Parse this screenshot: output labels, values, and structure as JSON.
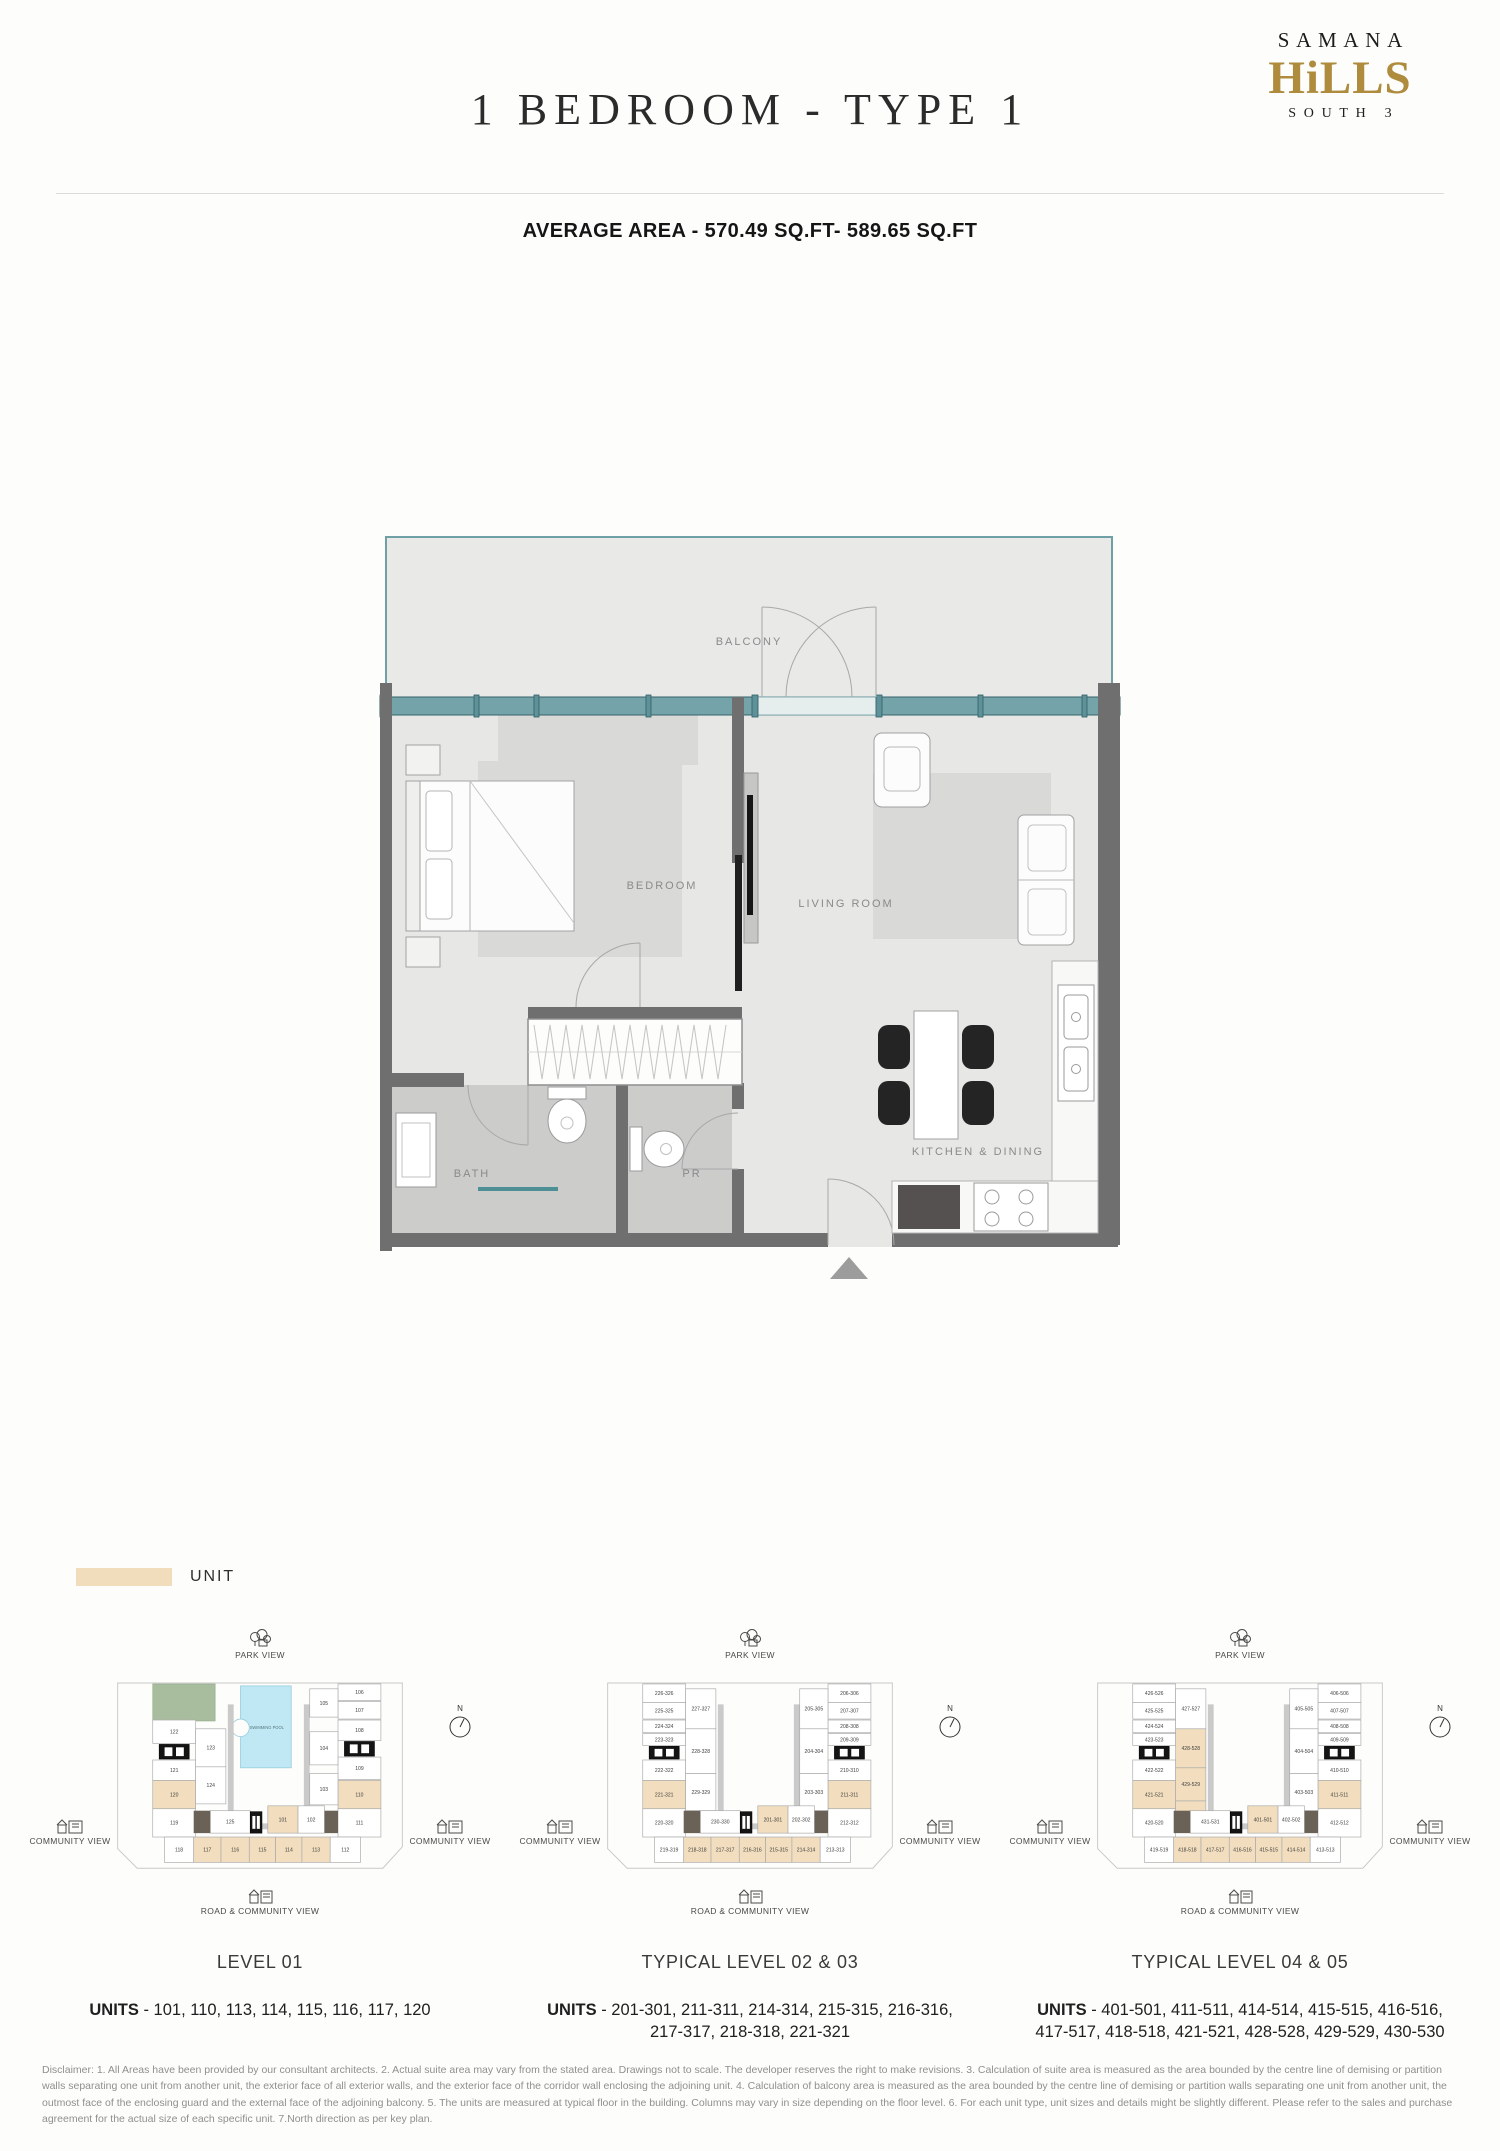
{
  "page": {
    "title": "1 BEDROOM - TYPE 1",
    "average_area": "AVERAGE AREA - 570.49 SQ.FT- 589.65 SQ.FT"
  },
  "logo": {
    "line1": "SAMANA",
    "line2": "HiLLS",
    "line3": "SOUTH 3",
    "gold": "#AF8C3D"
  },
  "legend": {
    "label": "UNIT",
    "swatch_color": "#F1DCBB"
  },
  "floorplan": {
    "labels": {
      "balcony": "BALCONY",
      "bedroom": "BEDROOM",
      "living": "LIVING ROOM",
      "bath": "BATH",
      "pr": "PR",
      "kitchen": "KITCHEN & DINING"
    },
    "colors": {
      "wall": "#6F6F6F",
      "glass": "#74A4AA",
      "highlight": "#F1DCBB"
    }
  },
  "keyplans": [
    {
      "caption": "LEVEL 01",
      "geometry": "level1",
      "compass": "N",
      "pool_label": "SWIMMING POOL",
      "views": {
        "park": "PARK VIEW",
        "community_left": "COMMUNITY VIEW",
        "community_right": "COMMUNITY VIEW",
        "road": "ROAD & COMMUNITY VIEW"
      },
      "units_prefix": "UNITS",
      "units_rest": " - 101, 110, 113, 114, 115, 116, 117, 120",
      "cells": {
        "left_outer": [
          {
            "t": "122"
          },
          {
            "t": "121"
          },
          {
            "t": "120",
            "h": 1
          },
          {
            "t": "119"
          }
        ],
        "left_inner": [
          {
            "t": "123"
          },
          {
            "t": "124"
          }
        ],
        "inner_bottom": {
          "t": "125"
        },
        "bottom_mid": [
          {
            "t": "101",
            "h": 1
          },
          {
            "t": "102"
          }
        ],
        "right_inner": [
          {
            "t": "105"
          },
          {
            "t": "104"
          },
          {
            "t": "103"
          }
        ],
        "right_outer": [
          {
            "t": "106"
          },
          {
            "t": "107"
          },
          {
            "t": "108"
          },
          {
            "t": "109"
          },
          {
            "t": "110",
            "h": 1
          },
          {
            "t": "111"
          }
        ],
        "bottom_row": [
          {
            "t": "118"
          },
          {
            "t": "117",
            "h": 1
          },
          {
            "t": "116",
            "h": 1
          },
          {
            "t": "115",
            "h": 1
          },
          {
            "t": "114",
            "h": 1
          },
          {
            "t": "113",
            "h": 1
          },
          {
            "t": "112"
          }
        ]
      }
    },
    {
      "caption": "TYPICAL LEVEL 02 & 03",
      "geometry": "typical",
      "compass": "N",
      "views": {
        "park": "PARK VIEW",
        "community_left": "COMMUNITY VIEW",
        "community_right": "COMMUNITY VIEW",
        "road": "ROAD & COMMUNITY VIEW"
      },
      "units_prefix": "UNITS",
      "units_rest": " - 201-301, 211-311, 214-314, 215-315, 216-316, 217-317, 218-318, 221-321",
      "cells": {
        "left_outer": [
          {
            "t": "226-326"
          },
          {
            "t": "225-325"
          },
          {
            "t": "224-324"
          },
          {
            "t": "223-323"
          },
          {
            "t": "222-322"
          },
          {
            "t": "221-321",
            "h": 1
          },
          {
            "t": "220-320"
          }
        ],
        "left_inner": [
          {
            "t": "227-327"
          },
          {
            "t": "228-328"
          },
          {
            "t": "229-329"
          }
        ],
        "inner_bottom": {
          "t": "230-330"
        },
        "bottom_mid": [
          {
            "t": "201-301",
            "h": 1
          },
          {
            "t": "202-302"
          }
        ],
        "right_inner": [
          {
            "t": "205-305"
          },
          {
            "t": "204-304"
          },
          {
            "t": "203-303"
          }
        ],
        "right_outer": [
          {
            "t": "206-306"
          },
          {
            "t": "207-307"
          },
          {
            "t": "208-308"
          },
          {
            "t": "209-309"
          },
          {
            "t": "210-310"
          },
          {
            "t": "211-311",
            "h": 1
          },
          {
            "t": "212-312"
          }
        ],
        "bottom_row": [
          {
            "t": "219-319"
          },
          {
            "t": "218-318",
            "h": 1
          },
          {
            "t": "217-317",
            "h": 1
          },
          {
            "t": "216-316",
            "h": 1
          },
          {
            "t": "215-315",
            "h": 1
          },
          {
            "t": "214-314",
            "h": 1
          },
          {
            "t": "213-313"
          }
        ]
      }
    },
    {
      "caption": "TYPICAL LEVEL 04 & 05",
      "geometry": "typical",
      "left_inner_geo": "g4",
      "compass": "N",
      "views": {
        "park": "PARK VIEW",
        "community_left": "COMMUNITY VIEW",
        "community_right": "COMMUNITY VIEW",
        "road": "ROAD & COMMUNITY VIEW"
      },
      "units_prefix": "UNITS",
      "units_rest": " - 401-501, 411-511, 414-514, 415-515, 416-516, 417-517, 418-518, 421-521, 428-528, 429-529, 430-530",
      "cells": {
        "left_outer": [
          {
            "t": "426-526"
          },
          {
            "t": "425-525"
          },
          {
            "t": "424-524"
          },
          {
            "t": "423-523"
          },
          {
            "t": "422-522"
          },
          {
            "t": "421-521",
            "h": 1
          },
          {
            "t": "420-520"
          }
        ],
        "left_inner": [
          {
            "t": "427-527"
          },
          {
            "t": "428-528",
            "h": 1
          },
          {
            "t": "429-529",
            "h": 1
          },
          {
            "t": "430-530",
            "h": 1
          }
        ],
        "inner_bottom": {
          "t": "431-531"
        },
        "bottom_mid": [
          {
            "t": "401-501",
            "h": 1
          },
          {
            "t": "402-502"
          }
        ],
        "right_inner": [
          {
            "t": "405-505"
          },
          {
            "t": "404-504"
          },
          {
            "t": "403-503"
          }
        ],
        "right_outer": [
          {
            "t": "406-506"
          },
          {
            "t": "407-507"
          },
          {
            "t": "408-508"
          },
          {
            "t": "409-509"
          },
          {
            "t": "410-510"
          },
          {
            "t": "411-511",
            "h": 1
          },
          {
            "t": "412-512"
          }
        ],
        "bottom_row": [
          {
            "t": "419-519"
          },
          {
            "t": "418-518",
            "h": 1
          },
          {
            "t": "417-517",
            "h": 1
          },
          {
            "t": "416-516",
            "h": 1
          },
          {
            "t": "415-515",
            "h": 1
          },
          {
            "t": "414-514",
            "h": 1
          },
          {
            "t": "413-513"
          }
        ]
      }
    }
  ],
  "disclaimer": "Disclaimer:  1. All Areas have been provided by our consultant architects. 2. Actual suite area may vary from the stated area. Drawings not to scale. The developer reserves the right to make revisions. 3. Calculation of suite area is measured as the area bounded by the centre line of demising or partition walls separating one unit from another unit, the exterior face of all exterior walls, and the exterior face of the corridor wall enclosing the adjoining unit. 4. Calculation of balcony area is measured as the area bounded by the centre line of demising or partition walls separating one unit from another unit, the outmost face of the enclosing guard and the external face of the adjoining balcony. 5. The units are measured at typical floor in the building. Columns may vary in size depending on the floor level. 6. For each unit type, unit sizes and details might be slightly different. Please refer to the sales and purchase agreement for the actual size of each specific unit. 7.North direction  as per key plan."
}
